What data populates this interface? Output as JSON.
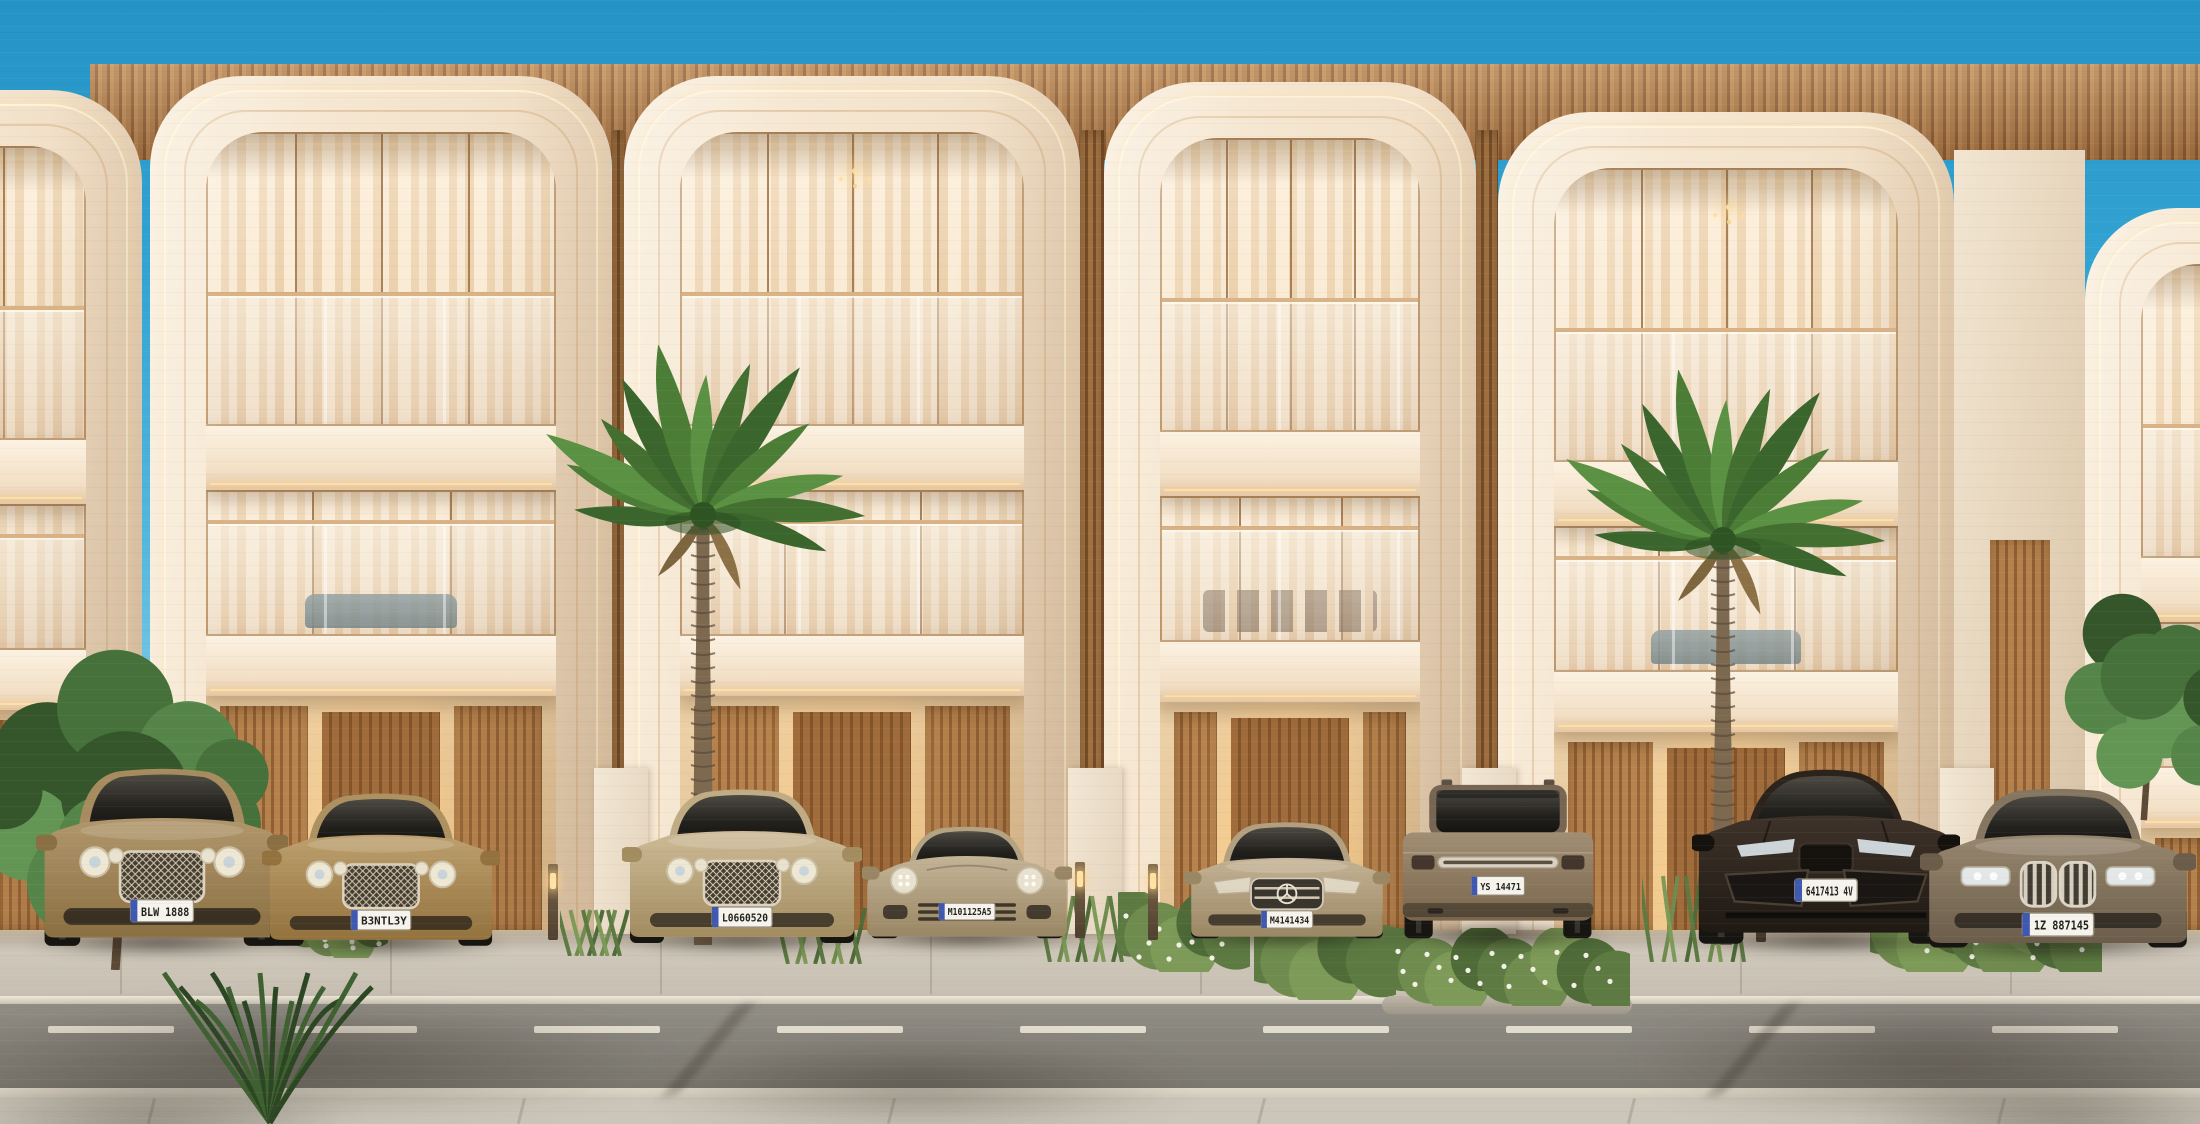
{
  "scene": {
    "title": "Luxury townhouse row — architectural render",
    "description": "Front elevation of modern three-storey townhouses with curved cream arch facades, wood slat accents, glass balconies, warm interior lighting, palm trees and luxury cars parked in driveways along a street",
    "time_of_day": "day",
    "sky_condition": "clear"
  },
  "palette": {
    "sky_top": "#2493c6",
    "sky_horizon": "#c2e9f6",
    "facade_cream": "#f3e2cb",
    "facade_shadow": "#e8d2b6",
    "wood_slat": "#b07c49",
    "wood_slat_dark": "#8a5a31",
    "balcony_white": "#fcf2e2",
    "interior_glow": "#ffd9a0",
    "glass_rail_tint": "#e2d4c2",
    "led_strip": "#ffeecb",
    "road_asphalt": "#86837b",
    "sidewalk_concrete": "#cbc6b9",
    "lane_dash": "#e9e3d5",
    "palm_green_dark": "#3a652c",
    "palm_green_light": "#5a9142",
    "trunk_brown": "#7d6950",
    "shadow": "#2a231c"
  },
  "buildings": {
    "visible_unit_count": 6,
    "features": [
      "curved-arch-frames",
      "led-cove-lighting",
      "glass-balustrades",
      "wood-slat-screens",
      "recessed-lit-entries",
      "two-balcony-levels"
    ],
    "units": [
      {
        "id": "townhouse-partial-left",
        "decor": "plain"
      },
      {
        "id": "townhouse-1",
        "decor": "lounge-sofa"
      },
      {
        "id": "townhouse-2",
        "decor": "chandelier"
      },
      {
        "id": "townhouse-3",
        "decor": "dining-set"
      },
      {
        "id": "townhouse-4",
        "decor": "chandelier-lounge"
      },
      {
        "id": "townhouse-partial-right",
        "decor": "plain"
      }
    ]
  },
  "vehicles": [
    {
      "name": "gold-luxury-suv",
      "view": "front",
      "body_color": "#b1976c",
      "body_dark": "#8a6f42",
      "roof_color": "#a68c5f",
      "plate": "BLW 1888"
    },
    {
      "name": "gold-luxury-sedan",
      "view": "front",
      "body_color": "#bda06e",
      "body_dark": "#93723e",
      "roof_color": "#ad9161",
      "plate": "B3NTL3Y"
    },
    {
      "name": "champagne-luxury-sedan",
      "view": "front",
      "body_color": "#cdbb97",
      "body_dark": "#a28c60",
      "roof_color": "#bfac85",
      "plate": "L0660520"
    },
    {
      "name": "champagne-sports-coupe",
      "view": "front",
      "body_color": "#c4b497",
      "body_dark": "#998664",
      "roof_color": "#b3a383",
      "plate": "M101125A5"
    },
    {
      "name": "champagne-sedan-star-emblem",
      "view": "front",
      "body_color": "#c4b295",
      "body_dark": "#9a8763",
      "roof_color": "#b2a081",
      "plate": "M4141434"
    },
    {
      "name": "bronze-luxury-suv",
      "view": "rear",
      "body_color": "#a18e74",
      "body_dark": "#79664d",
      "roof_color": "#776653",
      "plate": "YS 14471"
    },
    {
      "name": "dark-brown-performance-suv",
      "view": "front",
      "body_color": "#3e332a",
      "body_dark": "#1f1913",
      "roof_color": "#2b231c",
      "plate": "6417413 4V"
    },
    {
      "name": "bronze-luxury-sedan-kidney-grille",
      "view": "front",
      "body_color": "#97876f",
      "body_dark": "#6b5d4a",
      "roof_color": "#857662",
      "plate": "1Z 887145"
    }
  ],
  "street": {
    "lane_marking": "dashed-white-center-line",
    "surfaces": [
      "concrete-driveways",
      "curb",
      "asphalt-road",
      "foreground-sidewalk"
    ],
    "bollard_light_count": 4
  },
  "vegetation": {
    "items": [
      "palm-tree",
      "palm-tree",
      "leafy-tree-left",
      "leafy-tree-right",
      "flowering-shrubs",
      "ornamental-grasses",
      "foreground-grasses",
      "street-planter"
    ]
  }
}
